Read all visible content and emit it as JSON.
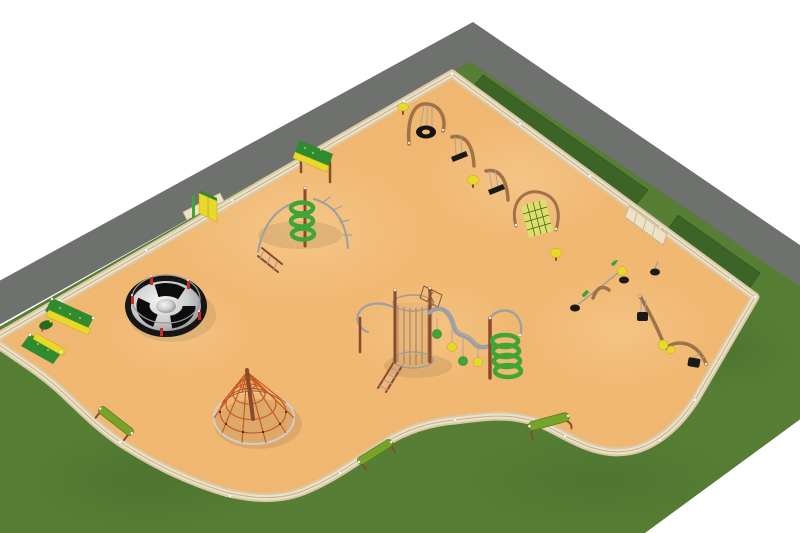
{
  "scene": {
    "description": "Aerial 3D render of a playground plan: curvy sand play area bordered by a wooden fence, lawn, hedge strips and a diagonal asphalt walkway",
    "regions": {
      "background": "White background",
      "path": "Asphalt walkway",
      "grass": "Lawn",
      "hedge": "Hedge strip",
      "sand": "Sand play surface",
      "fence": "Wooden perimeter fence"
    }
  },
  "palette": {
    "background": "#ffffff",
    "sand": "#F3B871",
    "sand-light": "#FBDCA8",
    "grass": "#557D32",
    "grass-dark": "#2E4D1C",
    "hedge": "#3B6426",
    "path": "#6E716D",
    "fence-base": "#D9C9A6",
    "fence-mid": "#EDE2C8",
    "fence-line": "#C2B18D",
    "equipment-green": "#3FA535",
    "equipment-dark-green": "#2E8B2E",
    "equipment-yellow": "#E8D929",
    "equipment-brown": "#8B4A2B",
    "wood": "#A07248",
    "metal": "#9AA0A3",
    "rope-orange": "#C2571F",
    "seat-black": "#1A1A1A",
    "bench-green": "#76A428",
    "carousel-red": "#C03028"
  },
  "equipment": [
    {
      "id": "climbing-wall-panel",
      "label": "Climbing wall panel"
    },
    {
      "id": "fence-gate-panel",
      "label": "Yellow gate panel"
    },
    {
      "id": "spiral-climber",
      "label": "Spiral climber with arched ladders"
    },
    {
      "id": "carousel",
      "label": "Merry-go-round carousel"
    },
    {
      "id": "rope-pyramid",
      "label": "Rope pyramid climbing net"
    },
    {
      "id": "corner-climbing-walls",
      "label": "Corner climbing ramps"
    },
    {
      "id": "corner-spring-rider",
      "label": "Spring rider"
    },
    {
      "id": "tire-swing",
      "label": "Tire swing"
    },
    {
      "id": "cantilever-swing-1",
      "label": "Cantilever swing"
    },
    {
      "id": "cantilever-swing-2",
      "label": "Cantilever swing"
    },
    {
      "id": "spring-pod-1",
      "label": "Spring pod seat"
    },
    {
      "id": "spring-pod-2",
      "label": "Spring pod seat"
    },
    {
      "id": "spring-pod-3",
      "label": "Spring pod seat"
    },
    {
      "id": "net-climber",
      "label": "Arched net climber"
    },
    {
      "id": "seesaw",
      "label": "Seesaw"
    },
    {
      "id": "spinner-seat",
      "label": "Spinner seat"
    },
    {
      "id": "baby-swings",
      "label": "Toddler bucket swings"
    },
    {
      "id": "adventure-complex",
      "label": "Climbing complex with cage tower, wavy traverse and spiral tunnel"
    },
    {
      "id": "bench-1",
      "label": "Bench"
    },
    {
      "id": "bench-2",
      "label": "Bench"
    },
    {
      "id": "bench-3",
      "label": "Bench"
    },
    {
      "id": "fence-gate-right",
      "label": "Fence gate"
    }
  ]
}
